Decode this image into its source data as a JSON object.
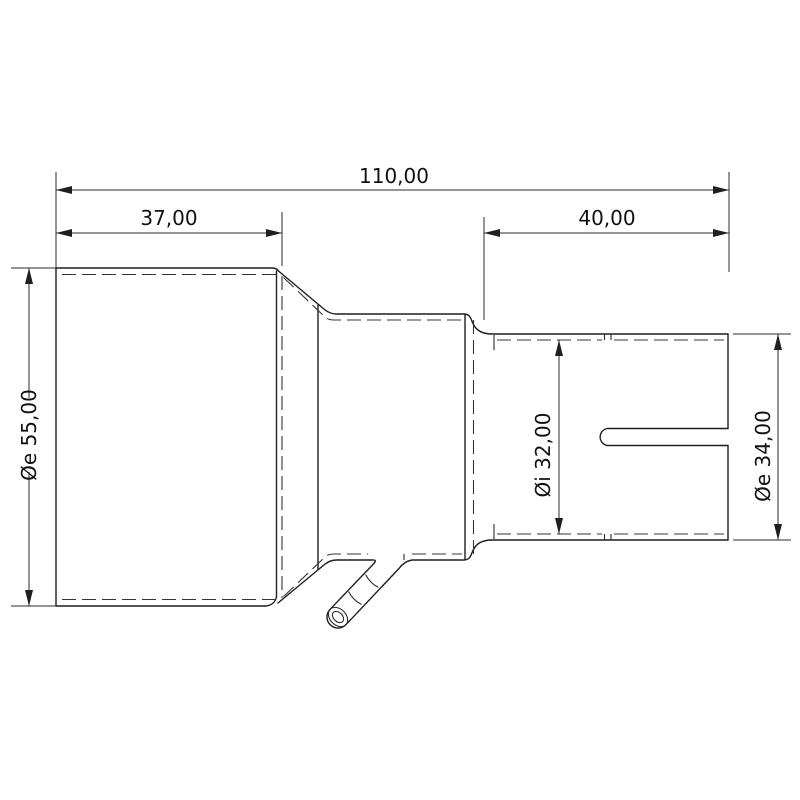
{
  "page": {
    "background": "#ffffff",
    "line_color": "#1f1f1f",
    "dimension_color": "#2b2b2b",
    "text_color": "#111111"
  },
  "drawing": {
    "kind": "technical-drawing",
    "labels": {
      "total_length": "110,00",
      "inlet_length": "37,00",
      "outlet_length": "40,00",
      "inlet_outer_diameter": "Øe 55,00",
      "outlet_inner_diameter": "Øi 32,00",
      "outlet_outer_diameter": "Øe 34,00"
    }
  }
}
